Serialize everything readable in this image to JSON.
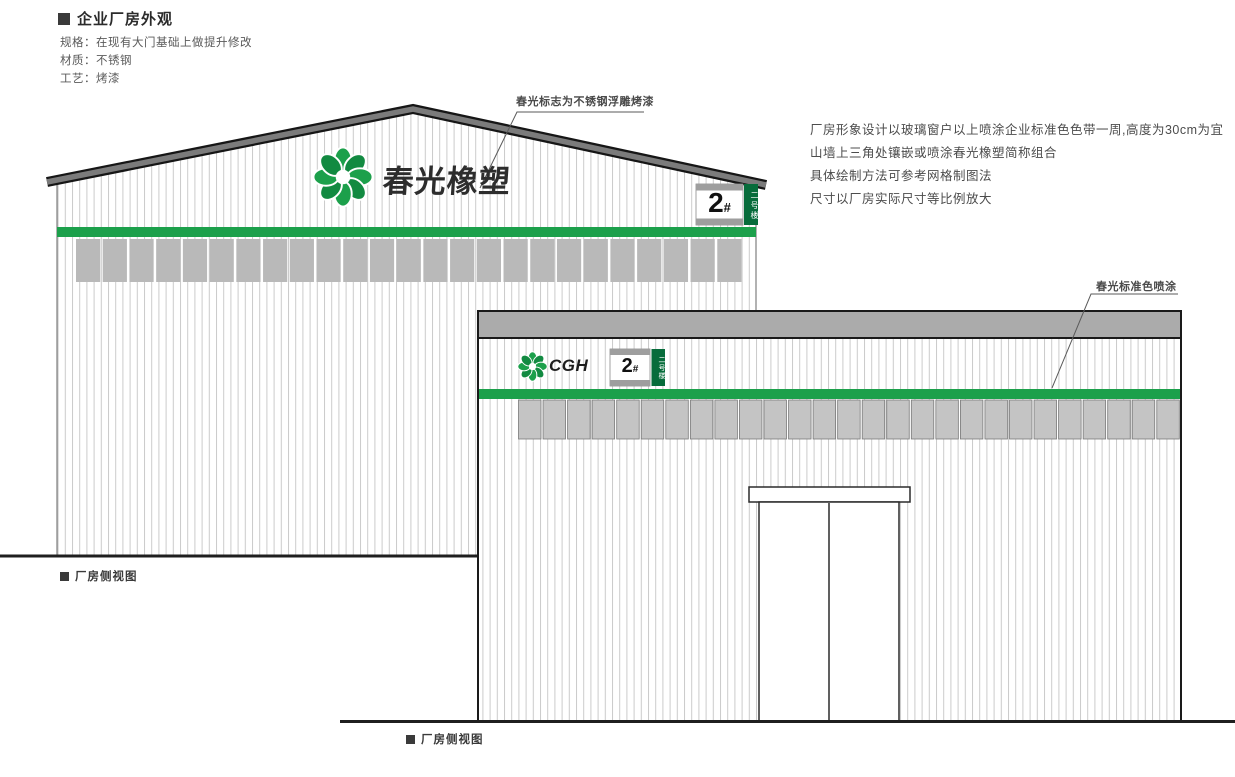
{
  "header": {
    "title": "企业厂房外观",
    "spec_lines": [
      "规格：在现有大门基础上做提升修改",
      "材质：不锈钢",
      "工艺：烤漆"
    ]
  },
  "notes": {
    "line1": "厂房形象设计以玻璃窗户以上喷涂企业标准色色带一周,高度为30cm为宜",
    "line2": "山墙上三角处镶嵌或喷涂春光橡塑简称组合",
    "line3": "具体绘制方法可参考网格制图法",
    "line4": "尺寸以厂房实际尺寸等比例放大"
  },
  "annotations": {
    "logo_material_note": "春光标志为不锈钢浮雕烤漆",
    "paint_color_note": "春光标准色喷涂"
  },
  "left_building": {
    "logo_text": "春光橡塑",
    "sign": {
      "number": "2",
      "hash": "#",
      "vertical_label": "二号楼"
    },
    "caption": "厂房侧视图"
  },
  "right_building": {
    "logo_text": "CGH",
    "sign": {
      "number": "2",
      "hash": "#",
      "vertical_label": "二号楼"
    },
    "caption": "厂房侧视图"
  },
  "colors": {
    "brand_green": "#1CA04B",
    "sign_dark_green": "#076C3B",
    "roof_gray": "#7B7B7B",
    "band_gray": "#ABABAB",
    "panel_gray_left": "#B9B9B9",
    "panel_gray_right": "#C4C4C4",
    "corrugation_line": "#CBCBCB",
    "ink": "#1F1F1F"
  }
}
